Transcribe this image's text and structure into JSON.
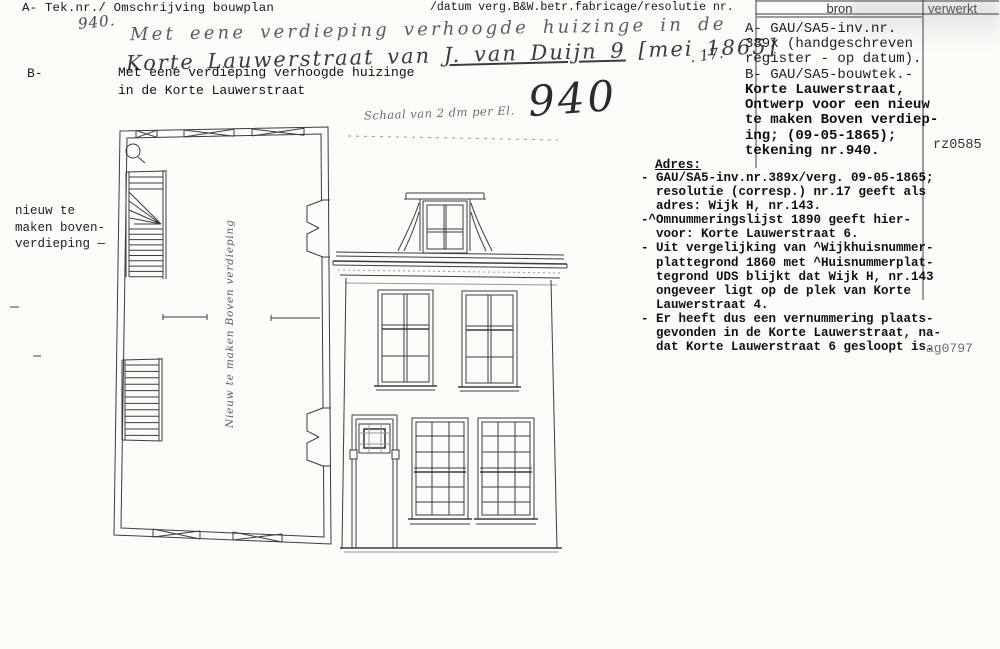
{
  "colors": {
    "paper": "#fbfbf8",
    "ink": "#1b1b1b",
    "drawing_line": "#3c3c3c"
  },
  "header": {
    "left_label": "A- Tek.nr./ Omschrijving bouwplan",
    "middle_label": "/datum verg.B&W.betr.fabricage/resolutie nr.",
    "bron_label": "bron",
    "verwerkt_label": "verwerkt"
  },
  "handwriting": {
    "tek_nr": "940.",
    "line1": "Met eene verdieping verhoogde huizinge in de",
    "line2_pre": "Korte Lauwerstraat van",
    "line2_name": "J. van Duijn 9",
    "line2_date": "[mei 1865]",
    "resolutie_nr": ". 17.",
    "big_number": "940",
    "schaal_note": "Schaal van 2 dm per El.",
    "plan_label": "Nieuw te maken Boven verdieping"
  },
  "typed": {
    "b_prefix": "B-",
    "description": "Met eene verdieping verhoogde huizinge\nin de Korte Lauwerstraat",
    "margin_note": "nieuw te\nmaken boven-\nverdieping —"
  },
  "bron": {
    "part1": "A- GAU/SA5-inv.nr.\n389x (handgeschreven\nregister - op datum).\nB- GAU/SA5-bouwtek.-",
    "part2": "Korte Lauwerstraat,\nOntwerp voor een nieuw\nte maken Boven verdiep-\ning; (09-05-1865);\ntekening nr.940."
  },
  "verwerkt": {
    "code_top": "rz0585",
    "code_bottom": "ag0797"
  },
  "adres": {
    "heading": "Adres:",
    "body": "- GAU/SA5-inv.nr.389x/verg. 09-05-1865;\n  resolutie (corresp.) nr.17 geeft als\n  adres: Wijk H, nr.143.\n-^Omnummeringslijst 1890 geeft hier-\n  voor: Korte Lauwerstraat 6.\n- Uit vergelijking van ^Wijkhuisnummer-\n  plattegrond 1860 met ^Huisnummerplat-\n  tegrond UDS blijkt dat Wijk H, nr.143\n  ongeveer ligt op de plek van Korte\n  Lauwerstraat 4.\n- Er heeft dus een vernummering plaats-\n  gevonden in de Korte Lauwerstraat, na-\n  dat Korte Lauwerstraat 6 gesloopt is."
  }
}
